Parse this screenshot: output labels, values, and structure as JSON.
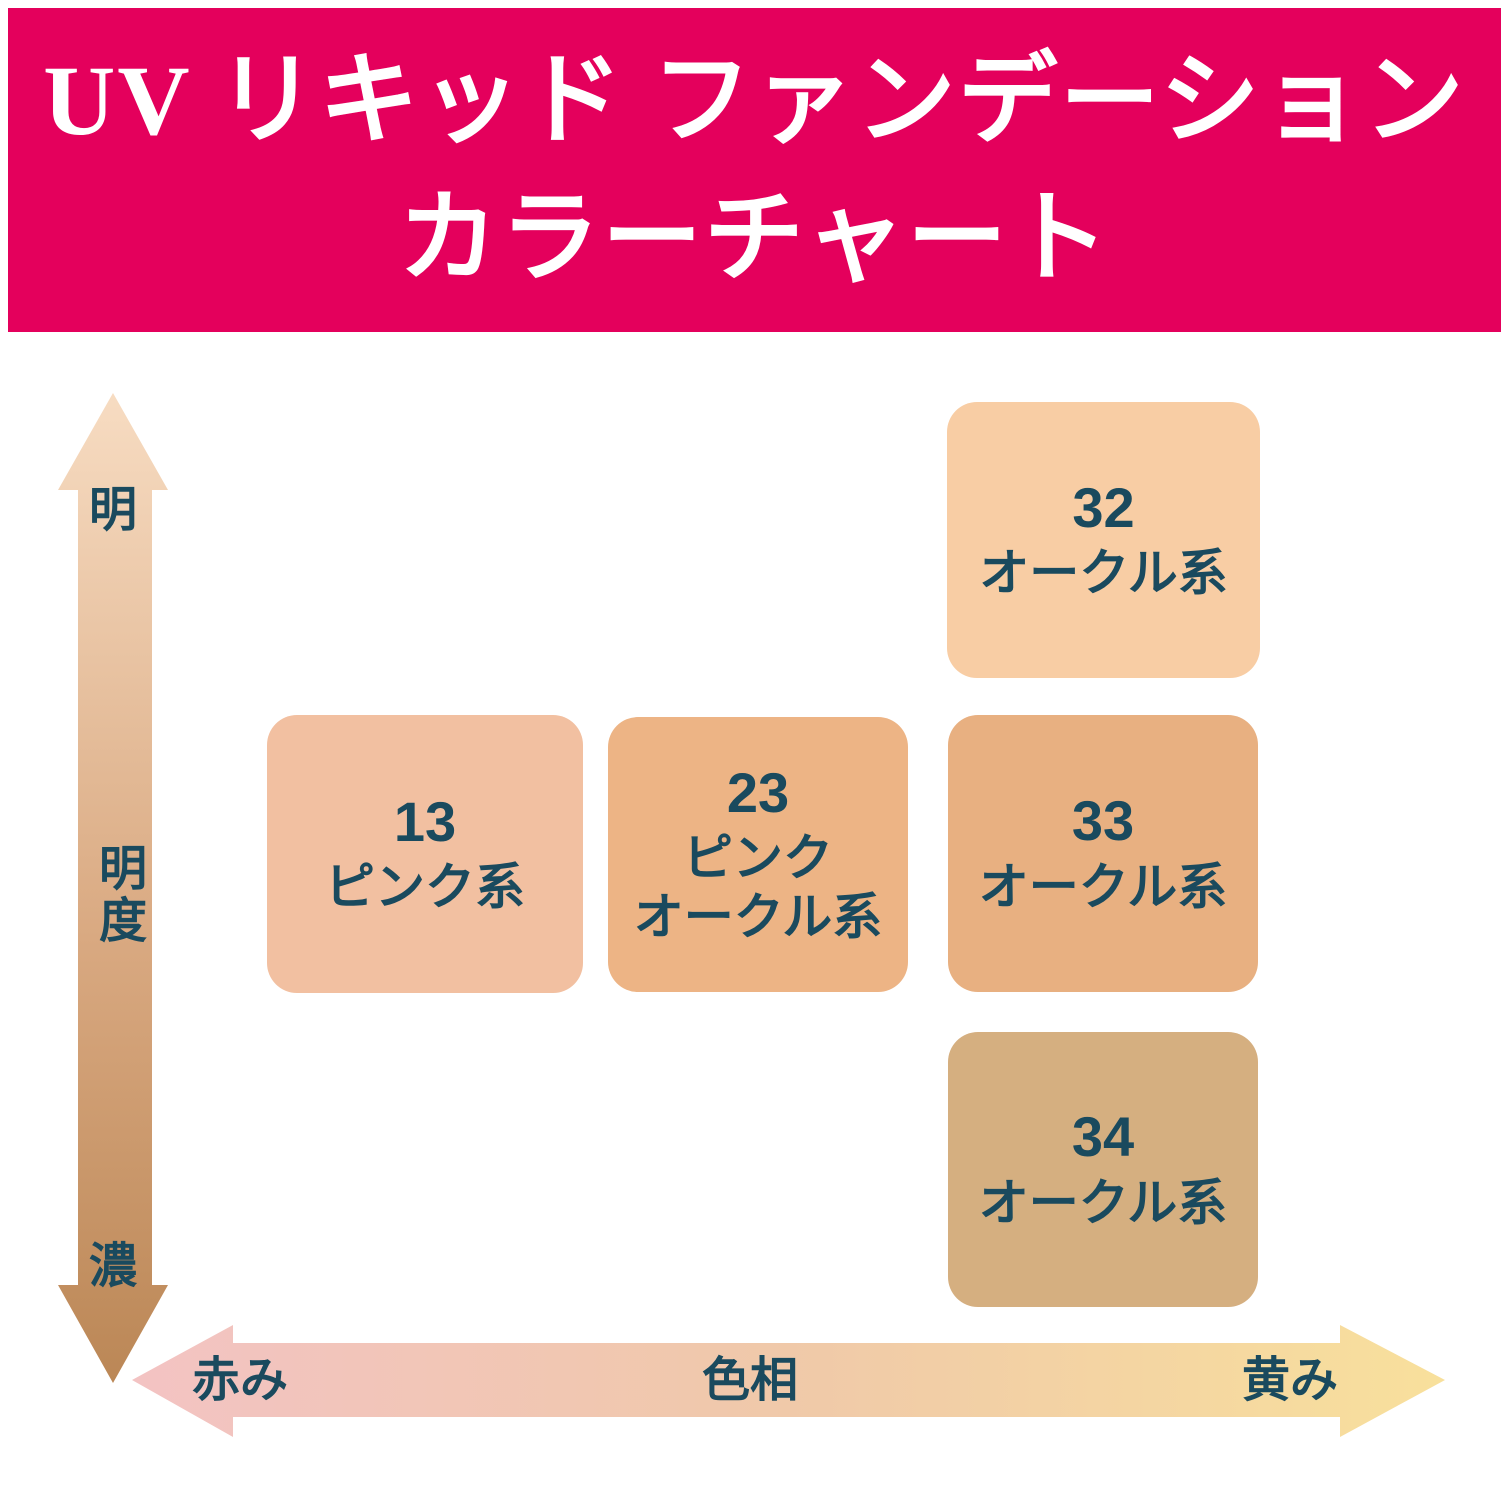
{
  "title": {
    "line1": "UV リキッド ファンデーション",
    "line2": "カラーチャート"
  },
  "colors": {
    "banner": "#E4005C",
    "title_text": "#FFFFFF",
    "label_text": "#1A4A5E",
    "vertical_arrow_gradient": [
      "#F7DCC2",
      "#D9A981",
      "#BB8756"
    ],
    "horizontal_arrow_gradient": [
      "#F3C3C3",
      "#F0C9A9",
      "#F8E09C"
    ]
  },
  "axes": {
    "vertical": {
      "name": "明度",
      "top_label": "明",
      "mid_label": "明度",
      "bottom_label": "濃"
    },
    "horizontal": {
      "name": "色相",
      "left_label": "赤み",
      "center_label": "色相",
      "right_label": "黄み"
    }
  },
  "shades": [
    {
      "number": "32",
      "label": "オークル系",
      "color": "#F8CDA4"
    },
    {
      "number": "13",
      "label": "ピンク系",
      "color": "#F2C0A1"
    },
    {
      "number": "23",
      "label": "ピンク\nオークル系",
      "color": "#EDB485"
    },
    {
      "number": "33",
      "label": "オークル系",
      "color": "#E8B081"
    },
    {
      "number": "34",
      "label": "オークル系",
      "color": "#D5AF80"
    }
  ],
  "chart_data": {
    "type": "scatter",
    "title": "UV リキッド ファンデーション カラーチャート",
    "xlabel": "色相",
    "ylabel": "明度",
    "x_axis": {
      "label": "色相",
      "left_end": "赤み",
      "right_end": "黄み"
    },
    "y_axis": {
      "label": "明度",
      "top_end": "明",
      "bottom_end": "濃"
    },
    "legend_position": "none",
    "grid": false,
    "points": [
      {
        "shade": "32",
        "name": "オークル系",
        "swatch_color": "#F8CDA4",
        "hue_position": 0.72,
        "lightness_position": 0.88
      },
      {
        "shade": "13",
        "name": "ピンク系",
        "swatch_color": "#F2C0A1",
        "hue_position": 0.22,
        "lightness_position": 0.52
      },
      {
        "shade": "23",
        "name": "ピンクオークル系",
        "swatch_color": "#EDB485",
        "hue_position": 0.47,
        "lightness_position": 0.52
      },
      {
        "shade": "33",
        "name": "オークル系",
        "swatch_color": "#E8B081",
        "hue_position": 0.72,
        "lightness_position": 0.52
      },
      {
        "shade": "34",
        "name": "オークル系",
        "swatch_color": "#D5AF80",
        "hue_position": 0.72,
        "lightness_position": 0.16
      }
    ]
  }
}
